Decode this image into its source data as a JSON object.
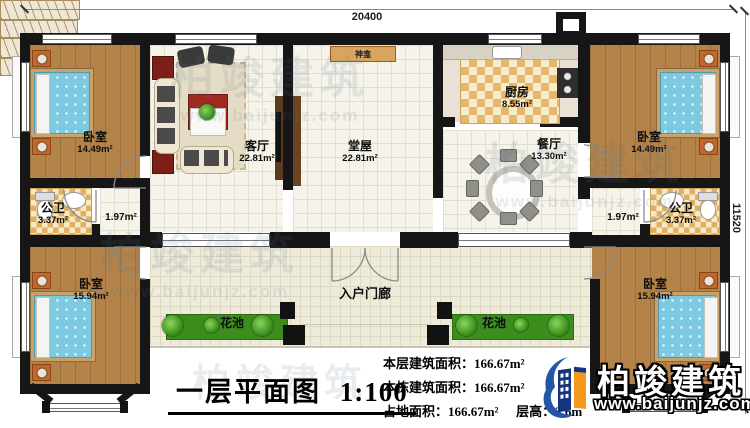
{
  "title": {
    "text": "一层平面图",
    "scale": "1:100"
  },
  "dimensions": {
    "top": "20400",
    "right": "11520"
  },
  "rooms": {
    "bedroom_tl": {
      "name": "卧室",
      "area": "14.49m²"
    },
    "bedroom_tr": {
      "name": "卧室",
      "area": "14.49m²"
    },
    "bedroom_bl": {
      "name": "卧室",
      "area": "15.94m²"
    },
    "bedroom_br": {
      "name": "卧室",
      "area": "15.94m²"
    },
    "living": {
      "name": "客厅",
      "area": "22.81m²"
    },
    "hall": {
      "name": "堂屋",
      "area": "22.81m²"
    },
    "kitchen": {
      "name": "厨房",
      "area": "8.55m²"
    },
    "dining": {
      "name": "餐厅",
      "area": "13.30m²"
    },
    "bath_left": {
      "name": "公卫",
      "area": "3.37m²"
    },
    "bath_right": {
      "name": "公卫",
      "area": "3.37m²"
    },
    "pass_left": {
      "area": "1.97m²"
    },
    "pass_right": {
      "area": "1.97m²"
    },
    "porch": {
      "name": "入户门廊"
    },
    "flower_left": {
      "name": "花池"
    },
    "flower_right": {
      "name": "花池"
    },
    "shrine": {
      "name": "神龛"
    }
  },
  "stats": {
    "rows": [
      {
        "label": "本层建筑面积：",
        "value": "166.67m²"
      },
      {
        "label": "本栋建筑面积：",
        "value": "166.67m²"
      },
      {
        "label": "占地面积：",
        "value": "166.67m²",
        "label2": "层高：",
        "value2": "3.6m"
      }
    ]
  },
  "logo": {
    "brand": "柏竣建筑",
    "url": "www.baijunjz.com"
  },
  "watermark": {
    "brand": "柏竣建筑",
    "url": "www.baijunjz.com"
  },
  "colors": {
    "wall": "#161616",
    "wood": "#b3834a",
    "bed": "#7cc9e0",
    "flower": "#3d8c1e",
    "brand_blue": "#2456a8",
    "brand_orange": "#f5991c"
  }
}
